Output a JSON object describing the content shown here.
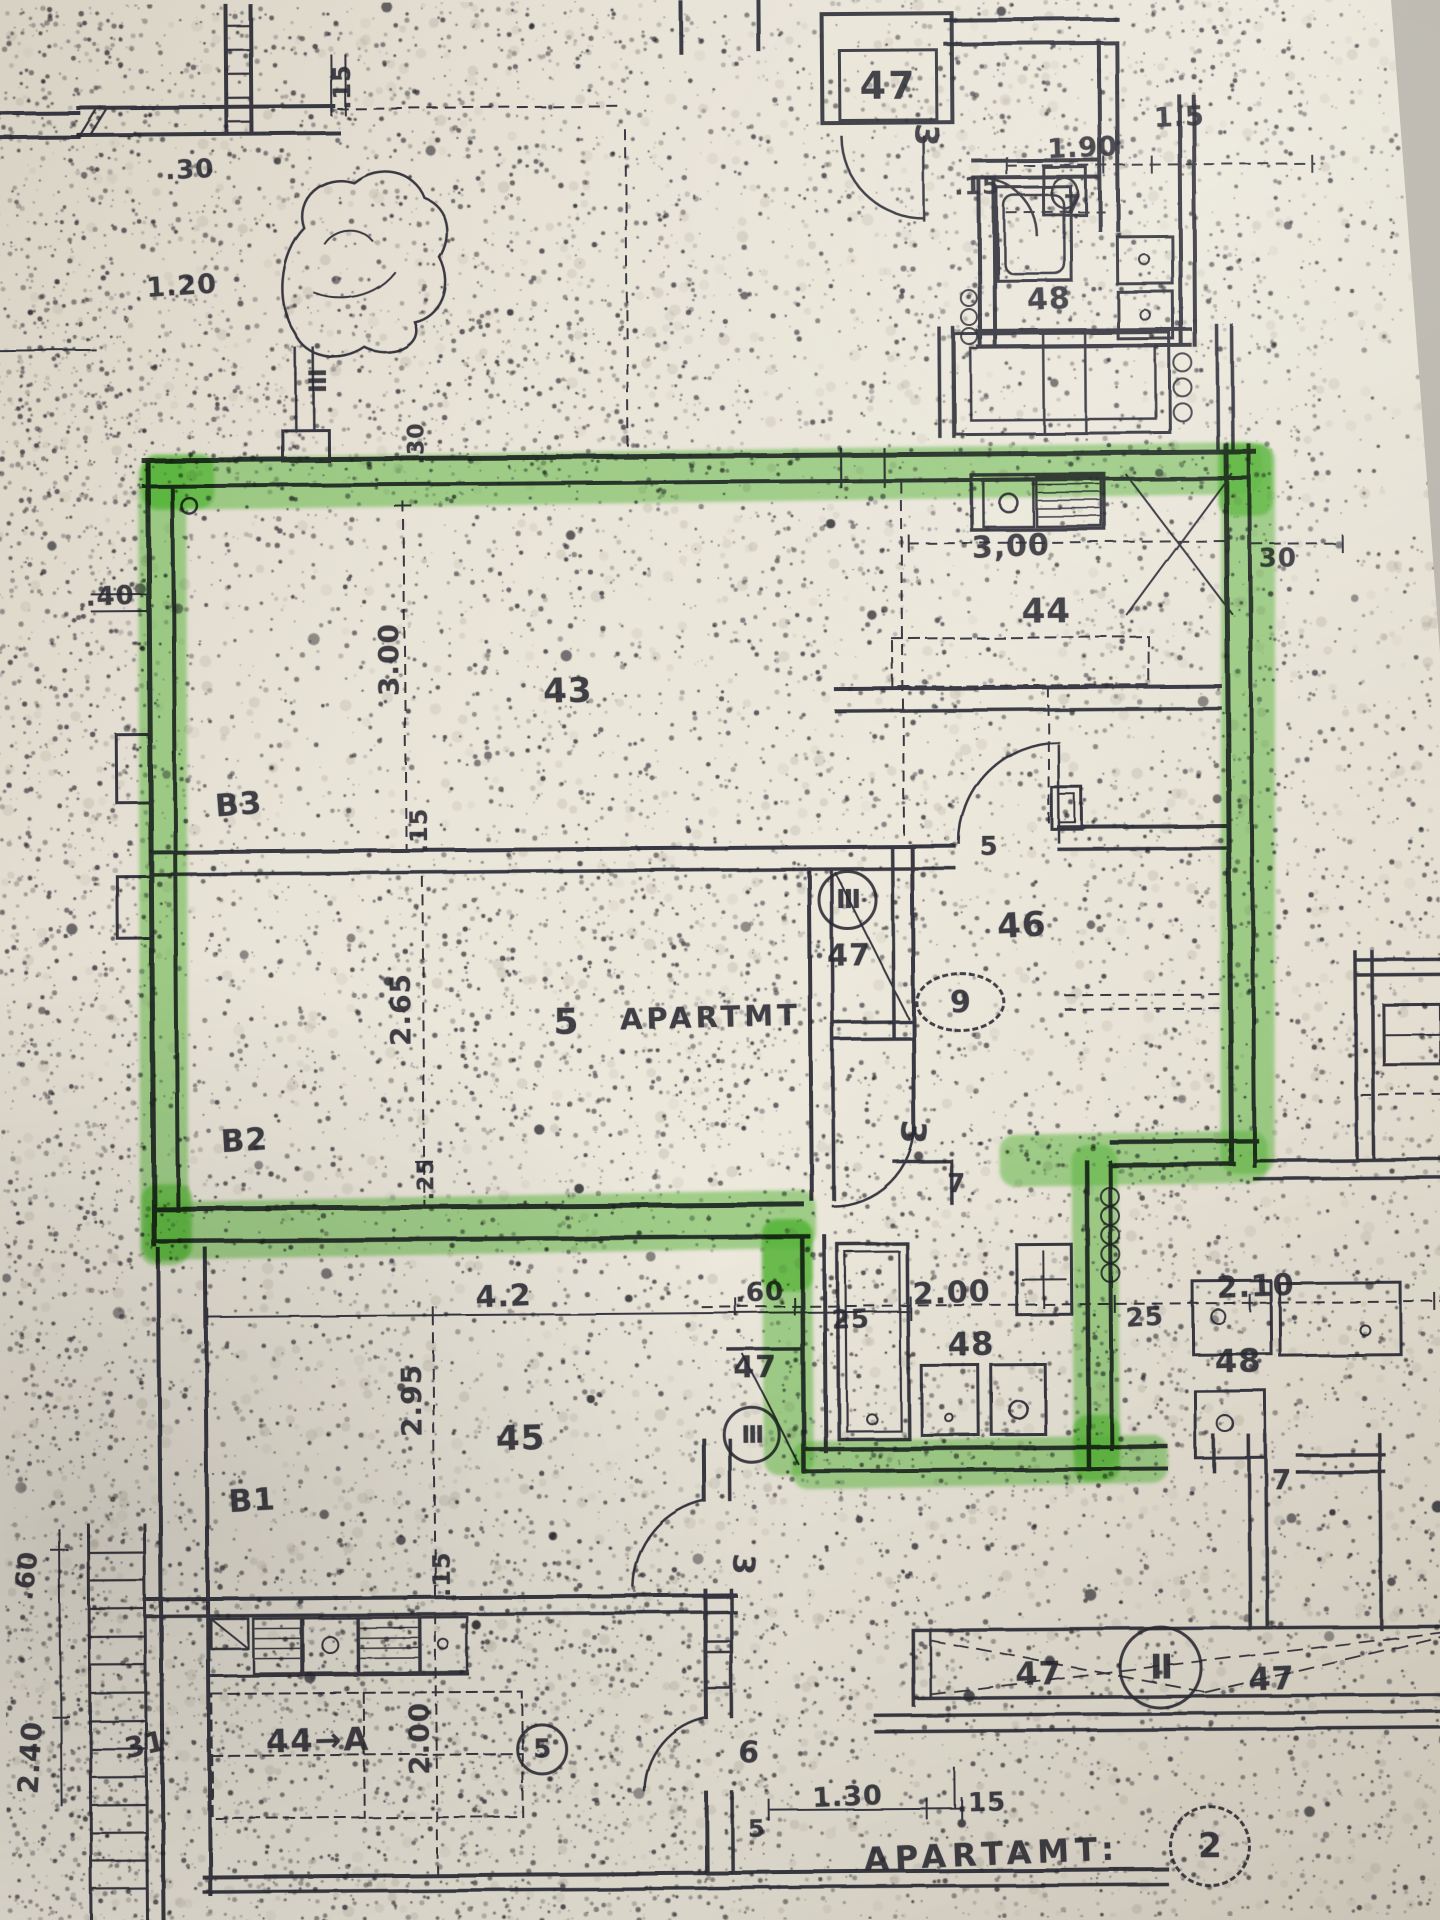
{
  "colors": {
    "ink": "#282832",
    "paper": "#e9e4d8",
    "highlight": "#55b337",
    "background_wedge": "#b5b1a8"
  },
  "boxed_tag": {
    "text": "47"
  },
  "labels": [
    {
      "n": "dim-030-topleft",
      "t": ".30",
      "x": 196,
      "y": 166,
      "s": 26,
      "r": -2
    },
    {
      "n": "dim-015-topleft-vertical",
      "t": ".15",
      "x": 349,
      "y": 84,
      "s": 24,
      "r": -90
    },
    {
      "n": "dim-120-topleft",
      "t": "1.20",
      "x": 187,
      "y": 282,
      "s": 27,
      "r": -3
    },
    {
      "n": "tag-iii-courtyard",
      "t": "III",
      "x": 321,
      "y": 377,
      "s": 24,
      "r": 90,
      "ls": -1
    },
    {
      "n": "dim-030-courtyard-vertical",
      "t": ".30",
      "x": 421,
      "y": 441,
      "s": 22,
      "r": -90
    },
    {
      "n": "dim-190-top",
      "t": "1.90",
      "x": 1089,
      "y": 151,
      "s": 27,
      "r": -2
    },
    {
      "n": "dim-15-topright",
      "t": "1.5",
      "x": 1186,
      "y": 121,
      "s": 27,
      "r": -2
    },
    {
      "n": "dim-015-top",
      "t": ".15",
      "x": 983,
      "y": 188,
      "s": 24,
      "r": -1
    },
    {
      "n": "dim-7-top",
      "t": "7",
      "x": 1079,
      "y": 208,
      "s": 26,
      "r": 0
    },
    {
      "n": "room-48-top",
      "t": "48",
      "x": 1054,
      "y": 302,
      "s": 30,
      "r": -2
    },
    {
      "n": "dim-300-kitchen",
      "t": "3,00",
      "x": 1014,
      "y": 549,
      "s": 30,
      "r": -2
    },
    {
      "n": "dim-30-right",
      "t": "30",
      "x": 1281,
      "y": 563,
      "s": 26,
      "r": 0
    },
    {
      "n": "room-44-kitchen",
      "t": "44",
      "x": 1049,
      "y": 614,
      "s": 34,
      "r": 0
    },
    {
      "n": "dim-040-left",
      "t": ".40",
      "x": 113,
      "y": 592,
      "s": 26,
      "r": -2
    },
    {
      "n": "dim-300-left-vertical",
      "t": "3.00",
      "x": 391,
      "y": 657,
      "s": 28,
      "r": -90
    },
    {
      "n": "room-43-living",
      "t": "43",
      "x": 570,
      "y": 690,
      "s": 34,
      "r": -1
    },
    {
      "n": "room-b3",
      "t": "B3",
      "x": 240,
      "y": 801,
      "s": 31,
      "r": -4
    },
    {
      "n": "dim-015-mid-vertical",
      "t": ".15",
      "x": 420,
      "y": 828,
      "s": 24,
      "r": -90
    },
    {
      "n": "dim-5-door",
      "t": "5",
      "x": 990,
      "y": 849,
      "s": 26,
      "r": 0
    },
    {
      "n": "room-46",
      "t": "46",
      "x": 1022,
      "y": 928,
      "s": 34,
      "r": -3
    },
    {
      "n": "room-47-shaft",
      "t": "47",
      "x": 849,
      "y": 957,
      "s": 30,
      "r": 0
    },
    {
      "n": "label-apartment-5",
      "t": "5",
      "x": 566,
      "y": 1021,
      "s": 36,
      "r": 0
    },
    {
      "n": "label-apartmt",
      "t": "APARTMT",
      "x": 710,
      "y": 1017,
      "s": 29,
      "r": -1,
      "ls": 4
    },
    {
      "n": "dim-265-vertical",
      "t": "2.65",
      "x": 400,
      "y": 1007,
      "s": 28,
      "r": -90
    },
    {
      "n": "dim-025-vertical",
      "t": ".25",
      "x": 425,
      "y": 1177,
      "s": 22,
      "r": -90
    },
    {
      "n": "room-b2",
      "t": "B2",
      "x": 243,
      "y": 1137,
      "s": 31,
      "r": -3
    },
    {
      "n": "dim-42",
      "t": "4.2",
      "x": 501,
      "y": 1295,
      "s": 30,
      "r": -2
    },
    {
      "n": "dim-295-vertical",
      "t": "2.95",
      "x": 408,
      "y": 1398,
      "s": 28,
      "r": -90
    },
    {
      "n": "room-45",
      "t": "45",
      "x": 517,
      "y": 1437,
      "s": 34,
      "r": -1
    },
    {
      "n": "dim-060-mid",
      "t": ".60",
      "x": 757,
      "y": 1293,
      "s": 26,
      "r": -2
    },
    {
      "n": "room-47-mid",
      "t": "47",
      "x": 752,
      "y": 1368,
      "s": 30,
      "r": 0
    },
    {
      "n": "dim-25-bath-left",
      "t": "25",
      "x": 848,
      "y": 1321,
      "s": 26,
      "r": -2
    },
    {
      "n": "dim-200-bath",
      "t": "2.00",
      "x": 949,
      "y": 1295,
      "s": 30,
      "r": -2
    },
    {
      "n": "room-48-bath",
      "t": "48",
      "x": 968,
      "y": 1346,
      "s": 32,
      "r": -1
    },
    {
      "n": "dim-7-bath",
      "t": "7",
      "x": 955,
      "y": 1186,
      "s": 26,
      "r": 0
    },
    {
      "n": "dim-25-bath-right",
      "t": "25",
      "x": 1142,
      "y": 1321,
      "s": 26,
      "r": -3
    },
    {
      "n": "dim-210-right",
      "t": "2.10",
      "x": 1253,
      "y": 1291,
      "s": 30,
      "r": -2
    },
    {
      "n": "room-48-right",
      "t": "48",
      "x": 1235,
      "y": 1365,
      "s": 32,
      "r": -1
    },
    {
      "n": "dim-7-right",
      "t": "7",
      "x": 1278,
      "y": 1484,
      "s": 28,
      "r": 0
    },
    {
      "n": "room-47-balcony-left",
      "t": "47",
      "x": 1033,
      "y": 1676,
      "s": 32,
      "r": -1
    },
    {
      "n": "room-47-balcony-right",
      "t": "47",
      "x": 1266,
      "y": 1683,
      "s": 32,
      "r": -2
    },
    {
      "n": "dim-130-bottom",
      "t": "1.30",
      "x": 841,
      "y": 1798,
      "s": 27,
      "r": -2
    },
    {
      "n": "dim-015-bottom",
      "t": ".15",
      "x": 975,
      "y": 1805,
      "s": 26,
      "r": -1
    },
    {
      "n": "label-apartamt",
      "t": "APARTAMT:",
      "x": 985,
      "y": 1856,
      "s": 32,
      "r": -2,
      "ls": 6
    },
    {
      "n": "room-44a",
      "t": "44→A",
      "x": 312,
      "y": 1737,
      "s": 32,
      "r": -1,
      "ls": 2
    },
    {
      "n": "label-31",
      "t": "31",
      "x": 139,
      "y": 1740,
      "s": 28,
      "r": -12
    },
    {
      "n": "dim-200-vertical-44a",
      "t": "2.00",
      "x": 413,
      "y": 1736,
      "s": 28,
      "r": -90
    },
    {
      "n": "dim-015-vertical-44a",
      "t": ".15",
      "x": 437,
      "y": 1572,
      "s": 24,
      "r": -90
    },
    {
      "n": "dim-060-left-vertical",
      "t": ".60",
      "x": 22,
      "y": 1570,
      "s": 26,
      "r": -83
    },
    {
      "n": "dim-240-left-vertical",
      "t": "2.40",
      "x": 24,
      "y": 1752,
      "s": 28,
      "r": -86
    },
    {
      "n": "room-b1",
      "t": "B1",
      "x": 248,
      "y": 1497,
      "s": 31,
      "r": -3
    },
    {
      "n": "window-tag-3-top",
      "t": "3",
      "x": 933,
      "y": 137,
      "s": 32,
      "r": 95
    },
    {
      "n": "window-tag-3-mid",
      "t": "3",
      "x": 911,
      "y": 1134,
      "s": 34,
      "r": 95
    },
    {
      "n": "window-tag-3-bottom",
      "t": "3",
      "x": 738,
      "y": 1565,
      "s": 30,
      "r": 95
    },
    {
      "n": "dim-6-bottom",
      "t": "6",
      "x": 743,
      "y": 1753,
      "s": 30,
      "r": 5
    },
    {
      "n": "dim-5-bottom",
      "t": "5",
      "x": 750,
      "y": 1829,
      "s": 24,
      "r": 0
    }
  ],
  "circled_tags": [
    {
      "n": "window-tag-circle-iii-corridor",
      "t": "III",
      "x": 845,
      "y": 898,
      "rx": 27,
      "ry": 27,
      "s": 26,
      "dashed": false
    },
    {
      "n": "window-tag-circle-iii-lower",
      "t": "III",
      "x": 745,
      "y": 1432,
      "rx": 26,
      "ry": 26,
      "s": 24,
      "dashed": false
    },
    {
      "n": "apartment-tag-9",
      "t": "9",
      "x": 957,
      "y": 1001,
      "rx": 42,
      "ry": 27,
      "s": 30,
      "dashed": true
    },
    {
      "n": "window-tag-circle-ii-balcony",
      "t": "II",
      "x": 1152,
      "y": 1668,
      "rx": 39,
      "ry": 39,
      "s": 34,
      "dashed": false
    },
    {
      "n": "apartment-tag-2",
      "t": "2",
      "x": 1200,
      "y": 1847,
      "rx": 38,
      "ry": 38,
      "s": 34,
      "dashed": true
    },
    {
      "n": "apartment-tag-5",
      "t": "5",
      "x": 533,
      "y": 1745,
      "rx": 23,
      "ry": 23,
      "s": 26,
      "dashed": false
    }
  ],
  "highlight_segments": [
    {
      "x": 146,
      "y": 450,
      "w": 1120,
      "h": 52,
      "r": -0.4,
      "dark": false
    },
    {
      "x": 140,
      "y": 455,
      "w": 48,
      "h": 806,
      "r": 0.3,
      "dark": false
    },
    {
      "x": 146,
      "y": 1194,
      "w": 668,
      "h": 58,
      "r": -0.6,
      "dark": false
    },
    {
      "x": 1222,
      "y": 448,
      "w": 54,
      "h": 730,
      "r": 0.5,
      "dark": false
    },
    {
      "x": 998,
      "y": 1136,
      "w": 268,
      "h": 52,
      "r": -0.5,
      "dark": false
    },
    {
      "x": 1070,
      "y": 1148,
      "w": 46,
      "h": 322,
      "r": 0,
      "dark": false
    },
    {
      "x": 788,
      "y": 1440,
      "w": 376,
      "h": 48,
      "r": -0.6,
      "dark": false
    },
    {
      "x": 760,
      "y": 1220,
      "w": 50,
      "h": 256,
      "r": 0,
      "dark": false
    },
    {
      "x": 146,
      "y": 450,
      "w": 72,
      "h": 54,
      "r": 0,
      "dark": true
    },
    {
      "x": 1222,
      "y": 448,
      "w": 54,
      "h": 72,
      "r": 0,
      "dark": true
    },
    {
      "x": 140,
      "y": 1180,
      "w": 50,
      "h": 76,
      "r": 0,
      "dark": true
    },
    {
      "x": 1070,
      "y": 1418,
      "w": 46,
      "h": 66,
      "r": 0,
      "dark": true
    },
    {
      "x": 760,
      "y": 1220,
      "w": 50,
      "h": 72,
      "r": 0,
      "dark": true
    }
  ],
  "radiators": [
    {
      "n": "radiator-top",
      "x": 972,
      "y": 298,
      "count": 3,
      "r": 7,
      "gap": 19
    },
    {
      "n": "stove-burners-top-right",
      "x": 1185,
      "y": 364,
      "count": 3,
      "r": 8,
      "gap": 25
    },
    {
      "n": "radiator-bath",
      "x": 1106,
      "y": 1198,
      "count": 5,
      "r": 8,
      "gap": 19
    }
  ]
}
